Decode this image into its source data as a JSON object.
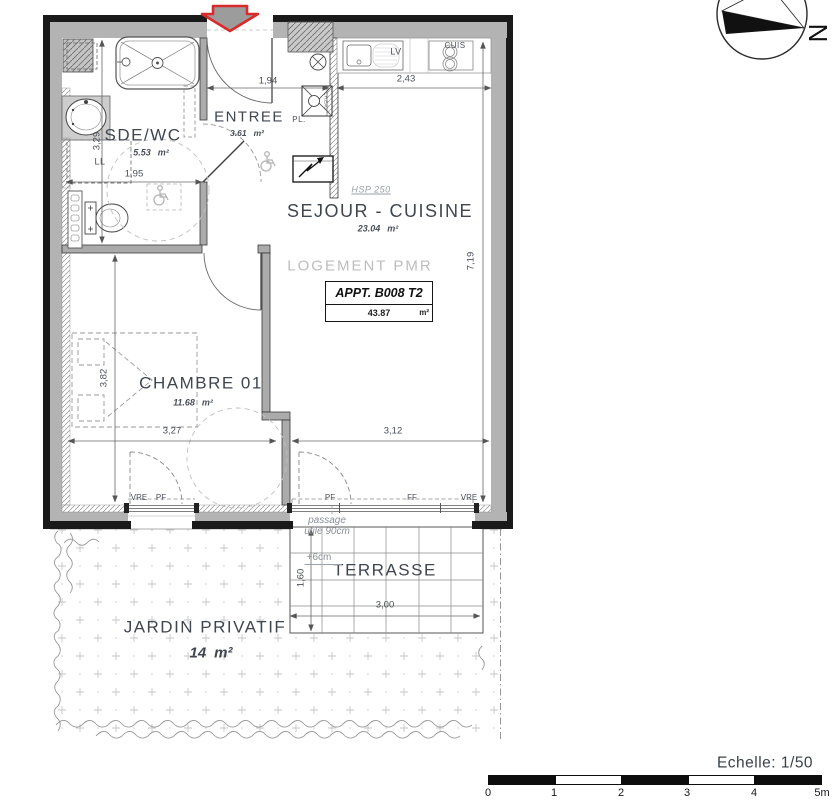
{
  "colors": {
    "accent_red": "#d92b2b",
    "wall_gray": "#b3b3b3",
    "ink": "#3f4650",
    "muted_gray": "#9aa0a8",
    "faint_gray": "#bdbdbd"
  },
  "compass": {
    "north": "N"
  },
  "apartment": {
    "pmr_label": "LOGEMENT PMR",
    "id": "APPT. B008 T2",
    "total_area": "43.87",
    "area_unit": "m²",
    "ceiling_height": "HSP 250"
  },
  "rooms": {
    "sde_wc": {
      "name": "SDE/WC",
      "area": "5.53",
      "unit": "m²"
    },
    "entree": {
      "name": "ENTREE",
      "area": "3.61",
      "unit": "m²"
    },
    "sejour_cuisine": {
      "name": "SEJOUR - CUISINE",
      "area": "23.04",
      "unit": "m²"
    },
    "chambre": {
      "name": "CHAMBRE 01",
      "area": "11.68",
      "unit": "m²"
    },
    "terrasse": {
      "name": "TERRASSE"
    },
    "jardin": {
      "name": "JARDIN PRIVATIF",
      "area": "14",
      "unit": "m²"
    }
  },
  "equipment": {
    "sink_dishwasher": "LV",
    "cooktop": "CUIS",
    "closet": "PL.",
    "washing_machine": "LL",
    "water_heater": "CH.EAU"
  },
  "dimensions": {
    "entree_width": "1,94",
    "cuisine_width": "2,43",
    "sejour_depth": "7,19",
    "sde_wc_depth": "3,29",
    "sde_wc_width": "1,95",
    "chambre_depth": "3,82",
    "chambre_width": "3,27",
    "sejour_width": "3,12",
    "terrasse_width": "3,00",
    "terrasse_depth": "1,60"
  },
  "windows": {
    "chambre_shutter": "VRE",
    "chambre_door": "PF",
    "sejour_door": "PF",
    "sejour_fixed": "FF",
    "sejour_shutter": "VRE"
  },
  "annotations": {
    "passage_line1": "passage",
    "passage_line2": "utile 90cm",
    "floor_offset": "+6cm"
  },
  "scale_bar": {
    "label": "Echelle: 1/50",
    "ticks": [
      "0",
      "1",
      "2",
      "3",
      "4",
      "5m"
    ]
  }
}
